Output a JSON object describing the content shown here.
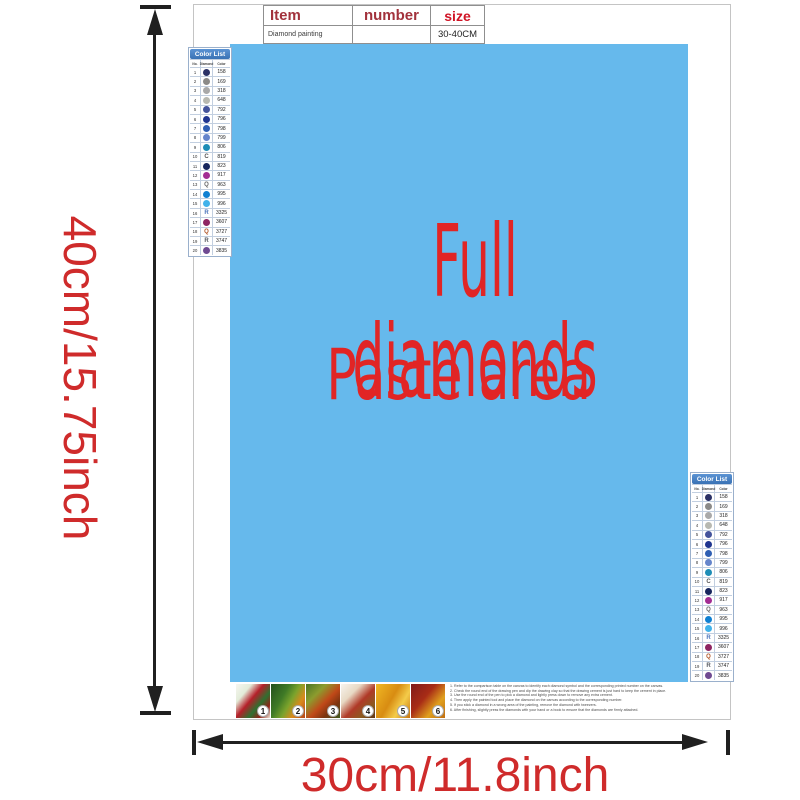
{
  "dimensions": {
    "height_label": "40cm/15.75inch",
    "width_label": "30cm/11.8inch",
    "text_color": "#cf2b2b",
    "arrow_color": "#202020"
  },
  "item_table": {
    "headers": [
      "Item",
      "number",
      "size"
    ],
    "row": {
      "item": "Diamond painting",
      "number": "",
      "size": "30-40CM"
    }
  },
  "paste_area": {
    "line1": "Full diamonds",
    "line2": "Paste area",
    "bg_color": "#66b9ec",
    "text_color": "#e12525"
  },
  "color_list": {
    "title": "Color List",
    "header_bg": "#4080c8",
    "columns": [
      "No.",
      "Diamond",
      "Color"
    ],
    "rows": [
      {
        "no": "1",
        "code": "158",
        "symbol": "circle",
        "color": "#2b3166"
      },
      {
        "no": "2",
        "code": "169",
        "symbol": "circle",
        "color": "#8b8a88"
      },
      {
        "no": "3",
        "code": "318",
        "symbol": "circle",
        "color": "#a9a9a9"
      },
      {
        "no": "4",
        "code": "648",
        "symbol": "circle",
        "color": "#b8b9b1"
      },
      {
        "no": "5",
        "code": "792",
        "symbol": "circle",
        "color": "#44549c"
      },
      {
        "no": "6",
        "code": "796",
        "symbol": "circle",
        "color": "#1f3590"
      },
      {
        "no": "7",
        "code": "798",
        "symbol": "circle",
        "color": "#2f5fb3"
      },
      {
        "no": "8",
        "code": "799",
        "symbol": "circle",
        "color": "#6585cb"
      },
      {
        "no": "9",
        "code": "806",
        "symbol": "circle",
        "color": "#1e8db6"
      },
      {
        "no": "10",
        "code": "819",
        "symbol": "letter",
        "letter": "C",
        "color": "#555555"
      },
      {
        "no": "11",
        "code": "823",
        "symbol": "circle",
        "color": "#17265e"
      },
      {
        "no": "12",
        "code": "917",
        "symbol": "circle",
        "color": "#a32d93"
      },
      {
        "no": "13",
        "code": "963",
        "symbol": "letter",
        "letter": "Q",
        "color": "#666666"
      },
      {
        "no": "14",
        "code": "995",
        "symbol": "circle",
        "color": "#0f80d2"
      },
      {
        "no": "15",
        "code": "996",
        "symbol": "circle",
        "color": "#41b2ea"
      },
      {
        "no": "16",
        "code": "3325",
        "symbol": "letter",
        "letter": "R",
        "color": "#4a74bc"
      },
      {
        "no": "17",
        "code": "3607",
        "symbol": "circle",
        "color": "#8e2562"
      },
      {
        "no": "18",
        "code": "3727",
        "symbol": "letter",
        "letter": "Q",
        "color": "#b05224"
      },
      {
        "no": "19",
        "code": "3747",
        "symbol": "letter",
        "letter": "R",
        "color": "#55585f"
      },
      {
        "no": "20",
        "code": "3835",
        "symbol": "circle",
        "color": "#6f4a92"
      }
    ]
  },
  "steps": [
    {
      "number": "1",
      "gradient": "linear-gradient(130deg,#f6f6f0 0%,#e3ecd9 25%,#b5202a 45%,#2f7030 65%,#8f2418 82%,#efe9db 100%)"
    },
    {
      "number": "2",
      "gradient": "linear-gradient(120deg,#24501c 0%,#3f7a26 35%,#7ba32c 55%,#d98a1c 75%,#b4441a 100%)"
    },
    {
      "number": "3",
      "gradient": "linear-gradient(135deg,#4a7424 0%,#8c9c2e 30%,#c04818 55%,#7c3410 75%,#3f5a1e 100%)"
    },
    {
      "number": "4",
      "gradient": "linear-gradient(135deg,#f7f4ee 0%,#e8d9c4 30%,#b03a28 55%,#8c5a20 78%,#5e3414 100%)"
    },
    {
      "number": "5",
      "gradient": "linear-gradient(120deg,#f0b824 0%,#d88c12 45%,#f4cc4a 70%,#c87410 100%)"
    },
    {
      "number": "6",
      "gradient": "linear-gradient(130deg,#801a1a 0%,#a82c16 40%,#e0a01e 70%,#c06c10 100%)"
    }
  ],
  "instructions": [
    "1. Refer to the comparison table on the canvas to identify each diamond symbol and the corresponding printed number on the canvas.",
    "2. Check the round end of the drawing pen and dip the drawing clay so that the drawing cement is just hard to keep the cement in place.",
    "3. Use the round end of the pen to pick a diamond and lightly press down to remove any extra cement.",
    "4. Then apply the painted tool and place the diamond on the canvas according to the corresponding number.",
    "5. If you stick a diamond in a wrong area of the painting, remove the diamond with tweezers.",
    "6. After finishing, slightly press the diamonds with your hand or a book to ensure that the diamonds are firmly attached."
  ]
}
